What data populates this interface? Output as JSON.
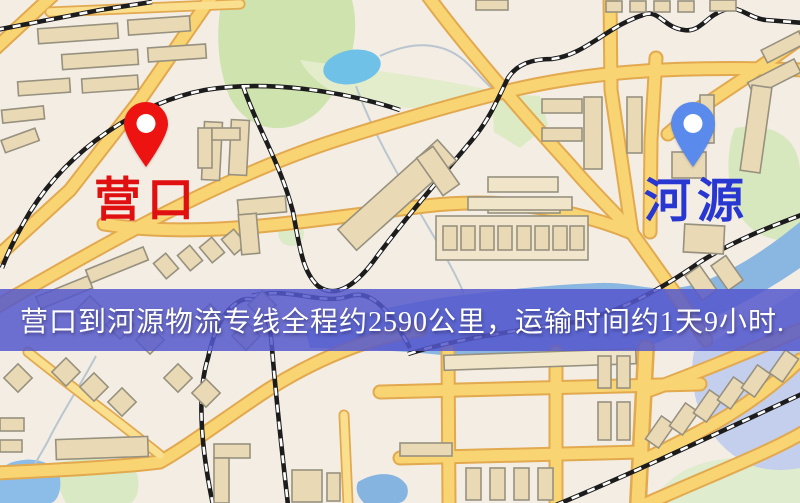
{
  "map": {
    "origin": {
      "label": "营口",
      "marker": "red-map-pin",
      "marker_color": "#ed1310",
      "label_color": "#e11010"
    },
    "destination": {
      "label": "河源",
      "marker": "blue-map-pin",
      "marker_color": "#598aec",
      "label_color": "#2837d2"
    }
  },
  "banner": {
    "text": "营口到河源物流专线全程约2590公里，运输时间约1天9小时.",
    "route": "营口到河源物流专线",
    "distance_text": "约2590公里",
    "duration_text": "约1天9小时",
    "background_color": "#5558cd",
    "text_color": "#ffffff"
  },
  "palette": {
    "map_background": "#f2eee4",
    "road_fill": "#f9d473",
    "road_casing": "#e2a94f",
    "park_green": "#d3e6b4",
    "water_blue": "#8ab6e2",
    "lake_blue": "#6fc1e8",
    "building_tan": "#ead9b5",
    "railway_black": "#1c1c1c"
  }
}
